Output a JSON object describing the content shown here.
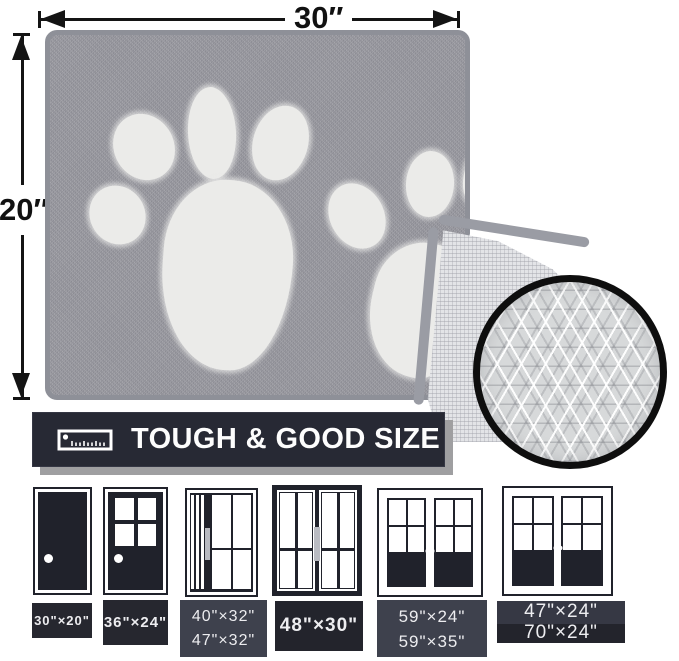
{
  "measurements": {
    "width": "30″",
    "height": "20″"
  },
  "banner": {
    "title": "TOUGH & GOOD SIZE",
    "icon": "ruler-icon"
  },
  "mat": {
    "description": "grey mat with two white paw prints, corner folded showing non-slip mesh backing",
    "inset": "magnified non-slip diamond texture"
  },
  "doors": {
    "items": [
      {
        "style": "solid-single-door",
        "sizes": [
          "30\"×20\""
        ]
      },
      {
        "style": "half-glass-single-door",
        "sizes": [
          "36\"×24\""
        ]
      },
      {
        "style": "sliding-door-side-panel",
        "sizes": [
          "40\"×32\"",
          "47\"×32\""
        ]
      },
      {
        "style": "double-sliding-glass-door",
        "sizes": [
          "48\"×30\""
        ]
      },
      {
        "style": "french-double-door",
        "sizes": [
          "59\"×24\"",
          "59\"×35\""
        ]
      },
      {
        "style": "french-double-door-wide",
        "sizes": [
          "47\"×24\"",
          "70\"×24\""
        ]
      }
    ]
  },
  "colors": {
    "mat_grey": "#97979e",
    "mat_edge": "#8e9098",
    "paw_white": "#ebebe9",
    "backing_mesh": "#e3e4e7",
    "circle_border": "#0e0e0e",
    "circle_fill": "#d7d9da",
    "banner_bg": "#272934",
    "banner_shadow": "#9f9fa1",
    "door_dark": "#20222b",
    "label_bg_dark": "#26272f",
    "label_bg_light": "#3e414d",
    "handle_grey": "#b9bbc2",
    "text_light": "#ededf0",
    "arrow_black": "#141414"
  }
}
